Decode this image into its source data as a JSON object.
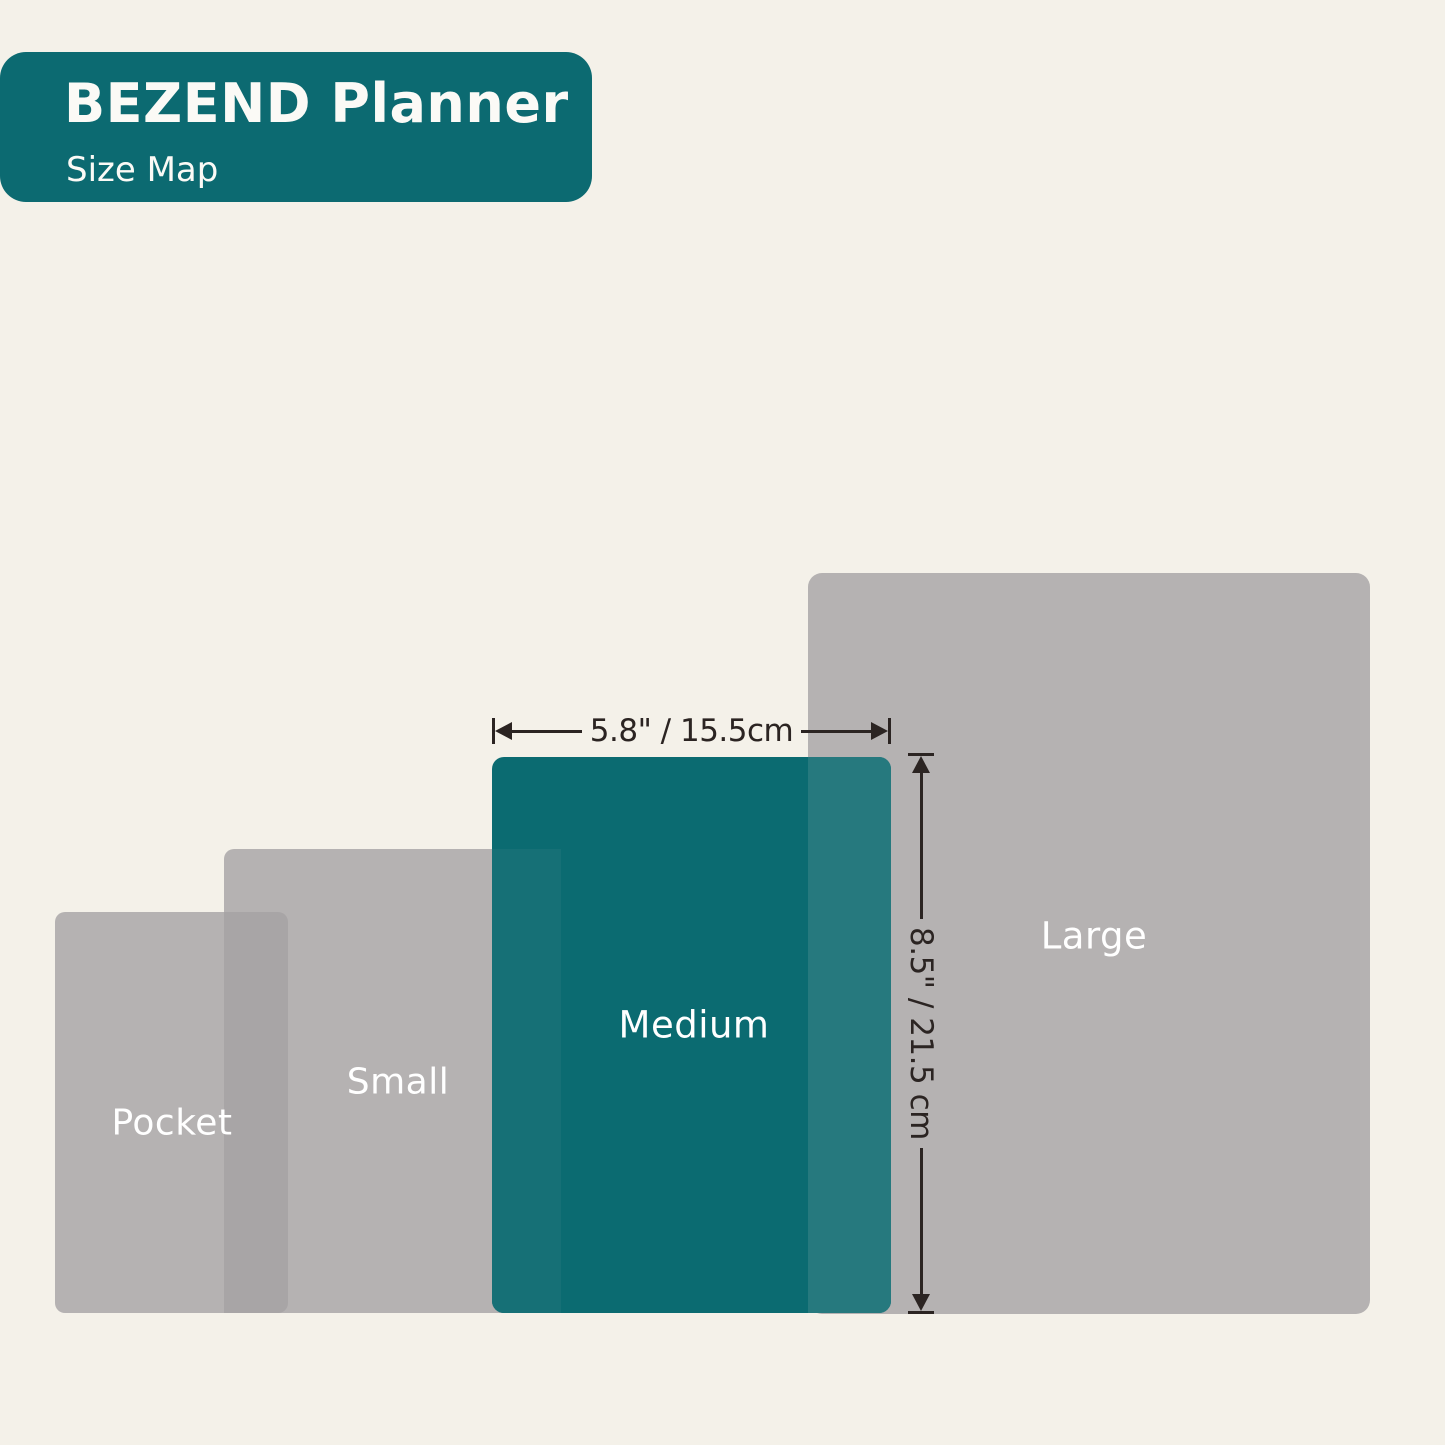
{
  "header": {
    "title": "BEZEND Planner",
    "subtitle": "Size Map"
  },
  "sizes": [
    {
      "id": "pocket",
      "label": "Pocket"
    },
    {
      "id": "small",
      "label": "Small"
    },
    {
      "id": "medium",
      "label": "Medium",
      "highlighted": true
    },
    {
      "id": "large",
      "label": "Large"
    }
  ],
  "highlighted_size": "Medium",
  "dimensions": {
    "width": "5.8\" / 15.5cm",
    "height": "8.5\" / 21.5 cm"
  },
  "colors": {
    "background": "#f4f1e9",
    "teal": "#0c6a71",
    "teal_medium": "#0b6b71",
    "teal_overlap_large": "#26797e",
    "teal_overlap_small": "#167076",
    "gray": "#b5b2b2",
    "gray_overlap": "#a8a5a6",
    "dimension": "#2b2422",
    "label_text": "#ffffff"
  }
}
